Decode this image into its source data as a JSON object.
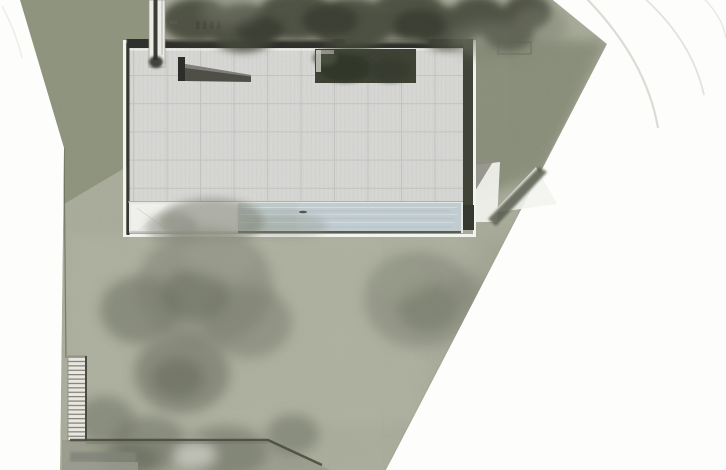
{
  "plan": {
    "kind": "architectural-site-plan",
    "colors": {
      "paper": "#fdfdfb",
      "margin_curve": "#e6e6e1",
      "arc": "#dcdcd6",
      "lawn_base": "#acaf9d",
      "lawn_nw": "#8d947c",
      "lawn_ne": "#7f856f",
      "lawn_south": "#b4b6a6",
      "lawn_strip": "#9b9d8e",
      "lawn_edge": "#9fa292",
      "tree_dark": "#454a3a",
      "tree_core": "#30342a",
      "tree_mid": "#7b7f6f",
      "tree_soft": "#8e9182",
      "tree_shadow": "#6f7365",
      "roof": "#dadad8",
      "roof_grid": "#c3c3c1",
      "roof_stripe": "#cdcdca",
      "roof_edge": "#2e2e2a",
      "white_trim": "#f6f6f2",
      "terrace": "#eaeae7",
      "paving_white": "#f3f3ef",
      "pool": "#c3ced3",
      "pool_light": "#e0e8eb",
      "pool_dark": "#a9b8bf",
      "pool_edge": "#575c51",
      "wall": "#4a4a40",
      "east_wall": "#3f4237",
      "courtyard": "#3c4133",
      "facade": "#a29e93",
      "hedge": "#565b4b",
      "stair_face": "#eceae3",
      "stair_line": "#74746a",
      "boundary_line": "#6b6e60"
    }
  }
}
